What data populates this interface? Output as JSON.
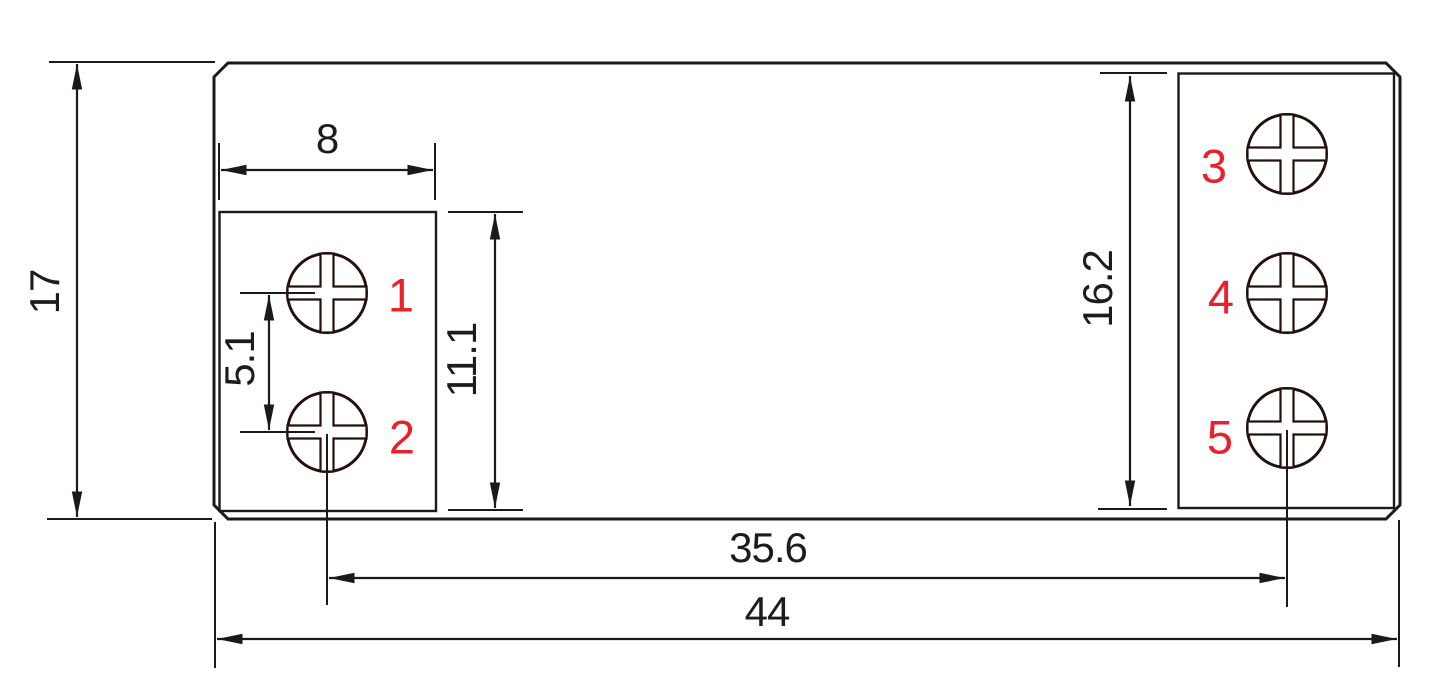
{
  "drawing": {
    "type": "mechanical-dimension-drawing",
    "dimensions": {
      "height_total": "17",
      "width_total": "44",
      "left_box_width": "8",
      "screw_pitch": "5.1",
      "left_box_height": "11.1",
      "right_box_height": "16.2",
      "screw2_to_screw5": "35.6"
    },
    "terminals": [
      "1",
      "2",
      "3",
      "4",
      "5"
    ],
    "colors": {
      "line": "#1a1a1a",
      "screw_line": "#23100c",
      "terminal_label": "#e8212b",
      "background": "#ffffff"
    }
  }
}
